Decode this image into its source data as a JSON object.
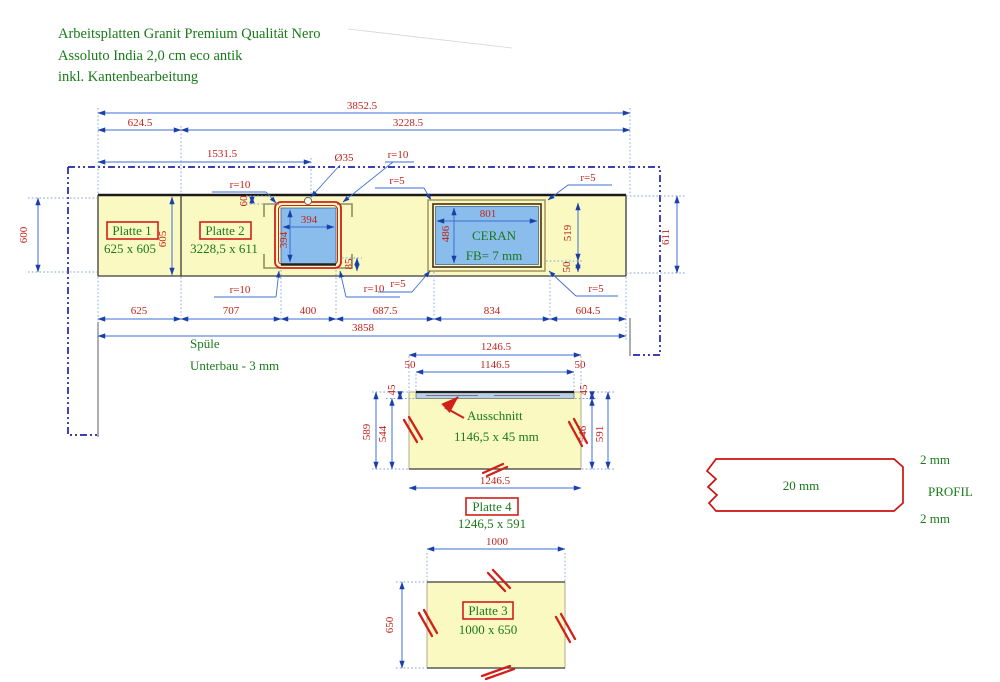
{
  "title": {
    "line1": "Arbeitsplatten Granit Premium Qualität Nero",
    "line2": "Assoluto India 2,0 cm eco antik",
    "line3": "inkl. Kantenbearbeitung"
  },
  "plates": {
    "p1": {
      "name": "Platte 1",
      "size": "625 x 605"
    },
    "p2": {
      "name": "Platte 2",
      "size": "3228,5 x 611"
    },
    "p3": {
      "name": "Platte 3",
      "size": "1000 x 650"
    },
    "p4": {
      "name": "Platte 4",
      "size": "1246,5 x 591"
    }
  },
  "ceran": {
    "label": "CERAN",
    "fb": "FB= 7 mm",
    "width": "801",
    "height": "486"
  },
  "sink": {
    "label1": "Spüle",
    "label2": "Unterbau - 3 mm",
    "width": "394",
    "height": "394",
    "hole": "Ø35",
    "top_offset": "60",
    "side_offset": "85"
  },
  "cutout": {
    "label": "Ausschnitt",
    "size": "1146,5 x 45 mm"
  },
  "profile": {
    "thickness": "20 mm",
    "top": "2 mm",
    "bottom": "2 mm",
    "label": "PROFIL"
  },
  "dims": {
    "top_overall": "3852.5",
    "top_left": "624.5",
    "top_right": "3228.5",
    "sink_pos": "1531.5",
    "bottom": [
      "625",
      "707",
      "400",
      "687.5",
      "834",
      "604.5"
    ],
    "bottom_overall": "3858",
    "left_600": "600",
    "p1_605": "605",
    "right_611": "611",
    "ceran_519": "519",
    "ceran_50": "50",
    "r10": "r=10",
    "r5": "r=5",
    "p4_top": "1246.5",
    "p4_slot": "1146.5",
    "p4_50l": "50",
    "p4_50r": "50",
    "p4_45l": "45",
    "p4_45r": "45",
    "p4_589": "589",
    "p4_544": "544",
    "p4_546": "546",
    "p4_591": "591",
    "p4_bottom": "1246.5",
    "p3_width": "1000",
    "p3_height": "650"
  },
  "colors": {
    "dim_red": "#c0241c",
    "label_green": "#1a7a1a",
    "cut_blue": "#8abcec",
    "slab_yellow": "#faf9c2",
    "dim_blue": "#3b6fd4",
    "outline_navy": "#2323ad",
    "cut_red": "#d02018"
  }
}
